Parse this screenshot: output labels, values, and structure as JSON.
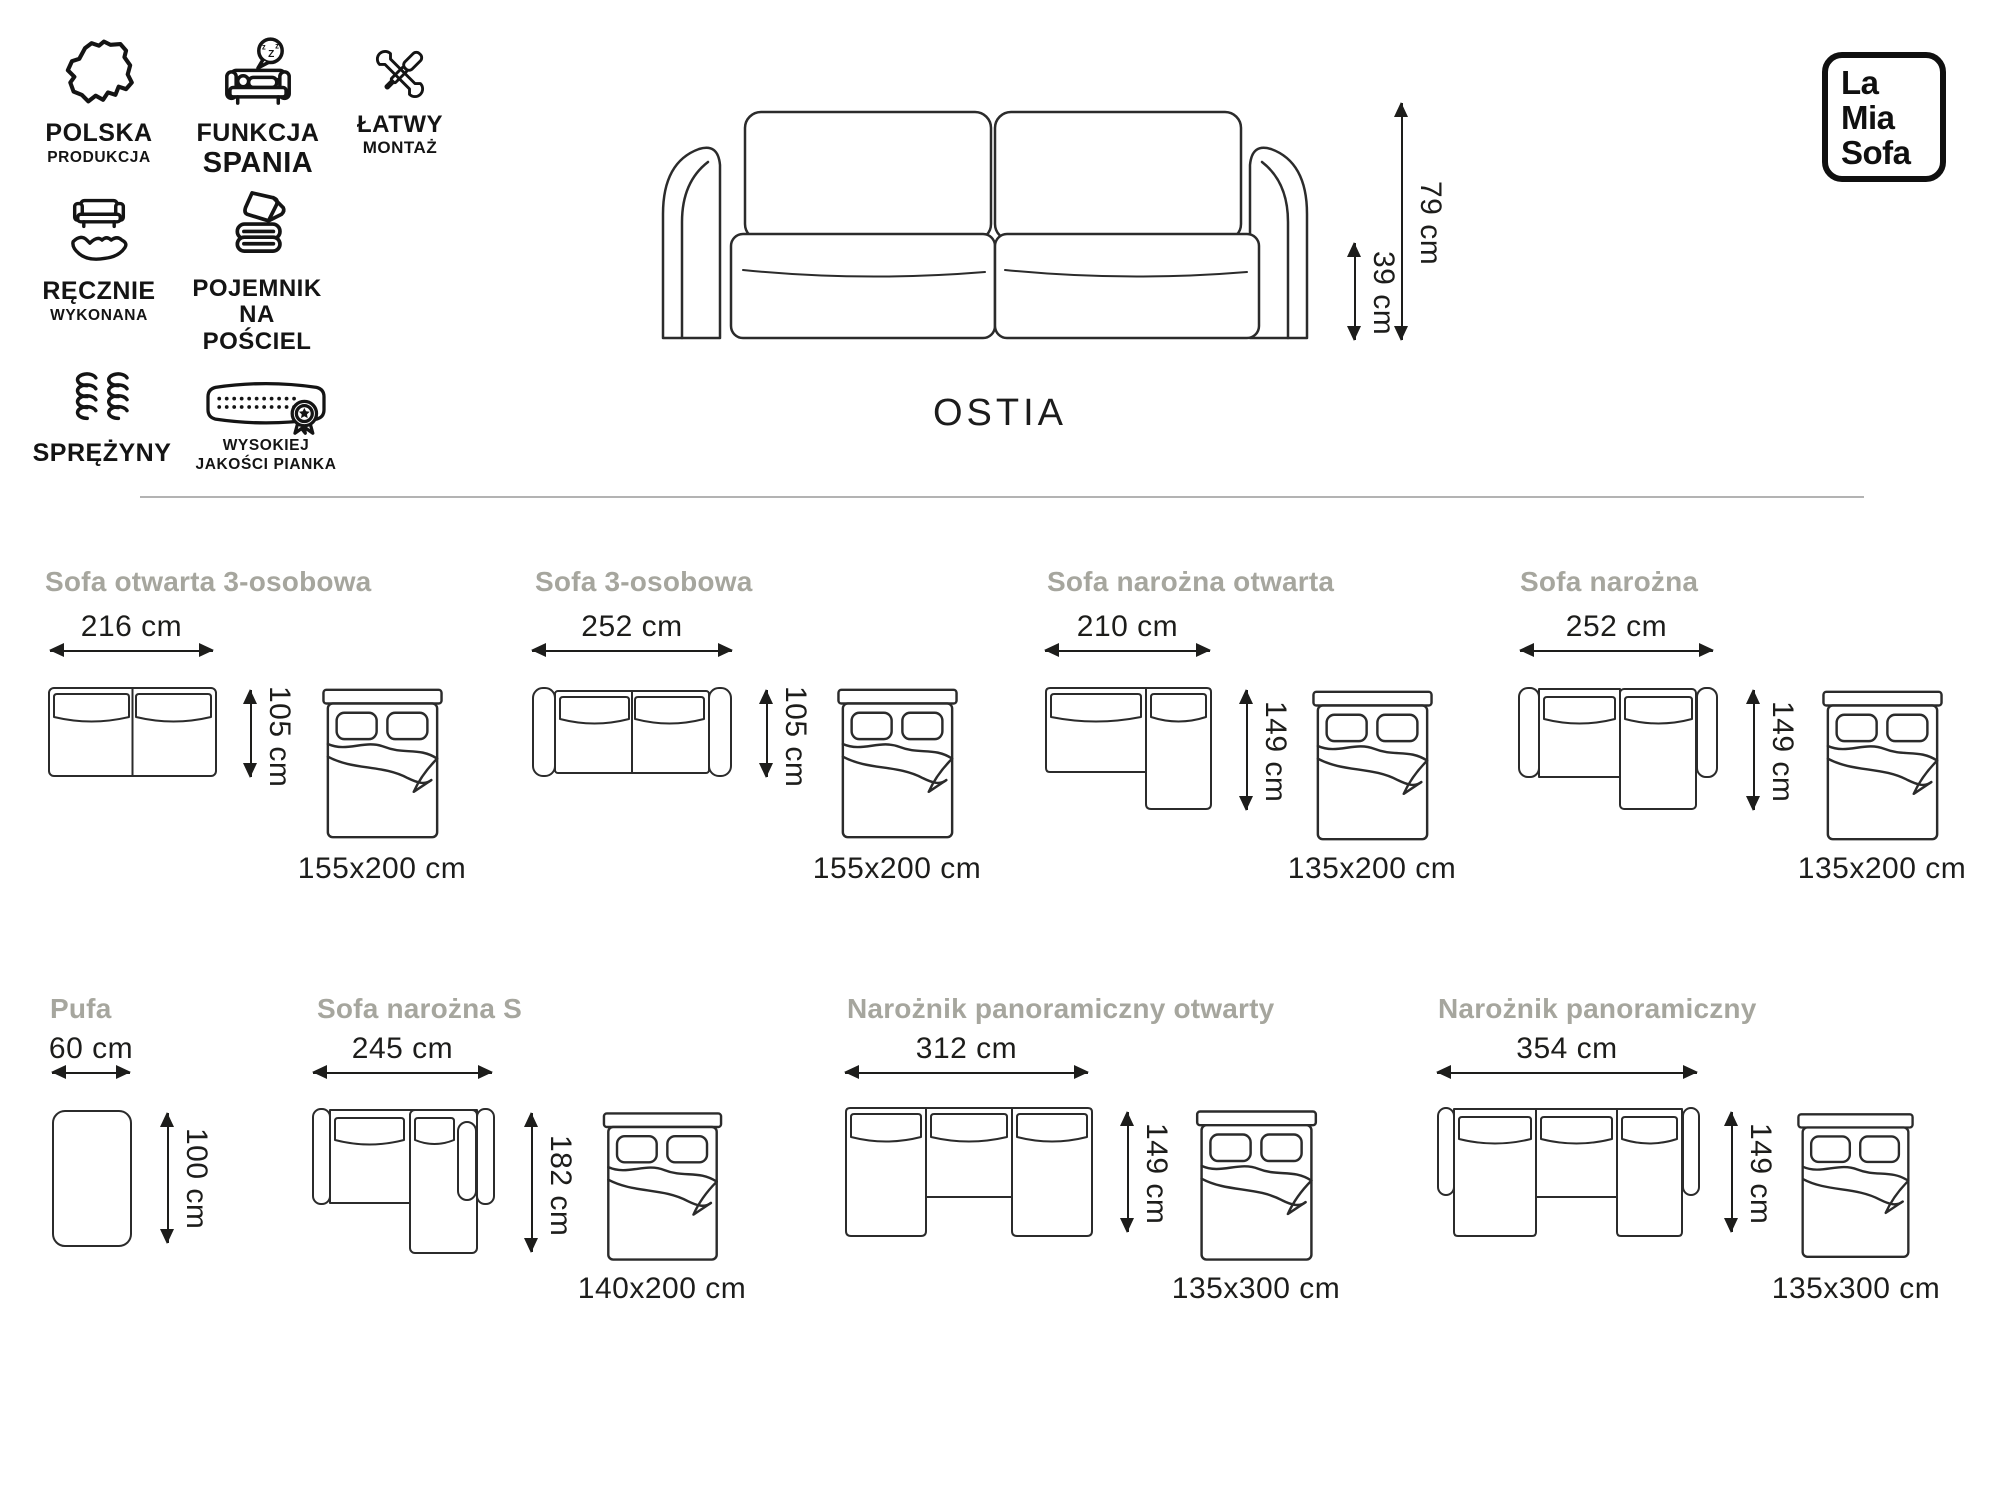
{
  "brand": {
    "line1": "La",
    "line2": "Mia",
    "line3": "Sofa"
  },
  "product": {
    "name": "OSTIA",
    "overall_height": "79 cm",
    "seat_height": "39 cm"
  },
  "features": [
    {
      "icon": "poland-map-icon",
      "line1": "POLSKA",
      "line2": "PRODUKCJA"
    },
    {
      "icon": "sleep-function-icon",
      "line1": "FUNKCJA",
      "line2": "SPANIA"
    },
    {
      "icon": "tools-icon",
      "line1": "ŁATWY",
      "line2": "MONTAŻ"
    },
    {
      "icon": "hand-sofa-icon",
      "line1": "RĘCZNIE",
      "line2": "WYKONANA"
    },
    {
      "icon": "bedding-container-icon",
      "line1": "POJEMNIK",
      "line2": "NA POŚCIEL"
    },
    {
      "icon": "springs-icon",
      "line1": "SPRĘŻYNY",
      "line2": ""
    },
    {
      "icon": "foam-quality-icon",
      "line1": "WYSOKIEJ",
      "line2": "JAKOŚCI PIANKA"
    }
  ],
  "configs": [
    {
      "title": "Sofa otwarta 3-osobowa",
      "width": "216 cm",
      "depth": "105 cm",
      "bed": "155x200 cm"
    },
    {
      "title": "Sofa 3-osobowa",
      "width": "252 cm",
      "depth": "105 cm",
      "bed": "155x200 cm"
    },
    {
      "title": "Sofa narożna otwarta",
      "width": "210 cm",
      "depth": "149 cm",
      "bed": "135x200 cm"
    },
    {
      "title": "Sofa narożna",
      "width": "252 cm",
      "depth": "149 cm",
      "bed": "135x200 cm"
    },
    {
      "title": "Pufa",
      "width": "60 cm",
      "depth": "100 cm",
      "bed": ""
    },
    {
      "title": "Sofa narożna S",
      "width": "245 cm",
      "depth": "182 cm",
      "bed": "140x200 cm"
    },
    {
      "title": "Narożnik panoramiczny otwarty",
      "width": "312 cm",
      "depth": "149 cm",
      "bed": "135x300 cm"
    },
    {
      "title": "Narożnik panoramiczny",
      "width": "354 cm",
      "depth": "149 cm",
      "bed": "135x300 cm"
    }
  ],
  "colors": {
    "ink": "#1d1d1b",
    "line_art": "#2b2b2b",
    "muted_title": "#a6a69e",
    "divider": "#b3b3b3",
    "background": "#ffffff"
  }
}
